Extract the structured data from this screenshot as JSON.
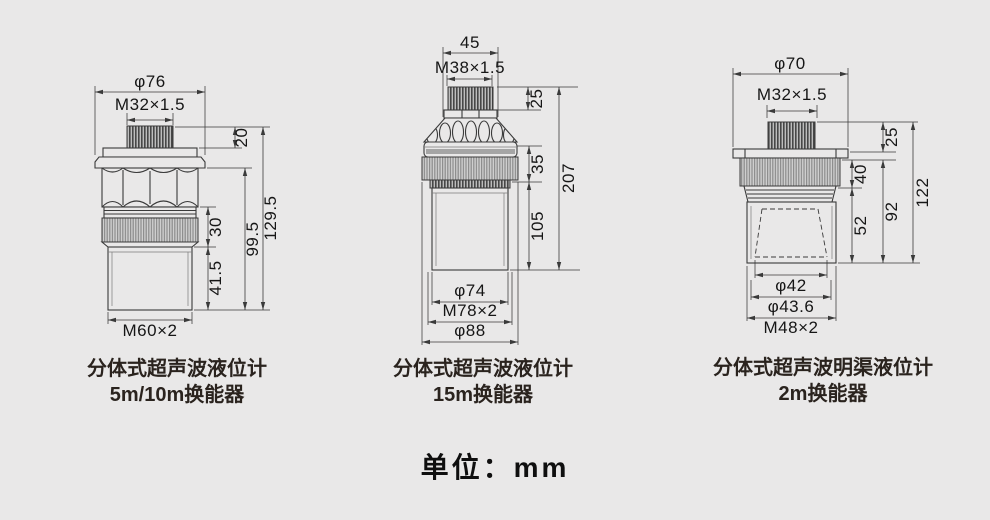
{
  "page": {
    "background_color": "#e9e8e8",
    "line_color": "#3a3a3a",
    "unit_label": "单位：mm"
  },
  "drawings": [
    {
      "caption_line1": "分体式超声波液位计",
      "caption_line2": "5m/10m换能器",
      "dims": {
        "flange_diameter": "φ76",
        "top_thread": "M32×1.5",
        "cap_height": "20",
        "ring_height": "30",
        "cylinder_height": "41.5",
        "body_height": "99.5",
        "total_height": "129.5",
        "bottom_thread": "M60×2"
      }
    },
    {
      "caption_line1": "分体式超声波液位计",
      "caption_line2": "15m换能器",
      "dims": {
        "top_width": "45",
        "top_thread": "M38×1.5",
        "cap_height": "25",
        "ring_height": "35",
        "cylinder_height": "105",
        "total_height": "207",
        "cylinder_diameter": "φ74",
        "body_thread": "M78×2",
        "flange_diameter": "φ88"
      }
    },
    {
      "caption_line1": "分体式超声波明渠液位计",
      "caption_line2": "2m换能器",
      "dims": {
        "flange_diameter": "φ70",
        "top_thread": "M32×1.5",
        "cap_height": "25",
        "ring_height": "40",
        "horn_height": "52",
        "body_height": "92",
        "total_height": "122",
        "horn_diameter": "φ42",
        "horn_outer_diameter": "φ43.6",
        "bottom_thread": "M48×2"
      }
    }
  ]
}
